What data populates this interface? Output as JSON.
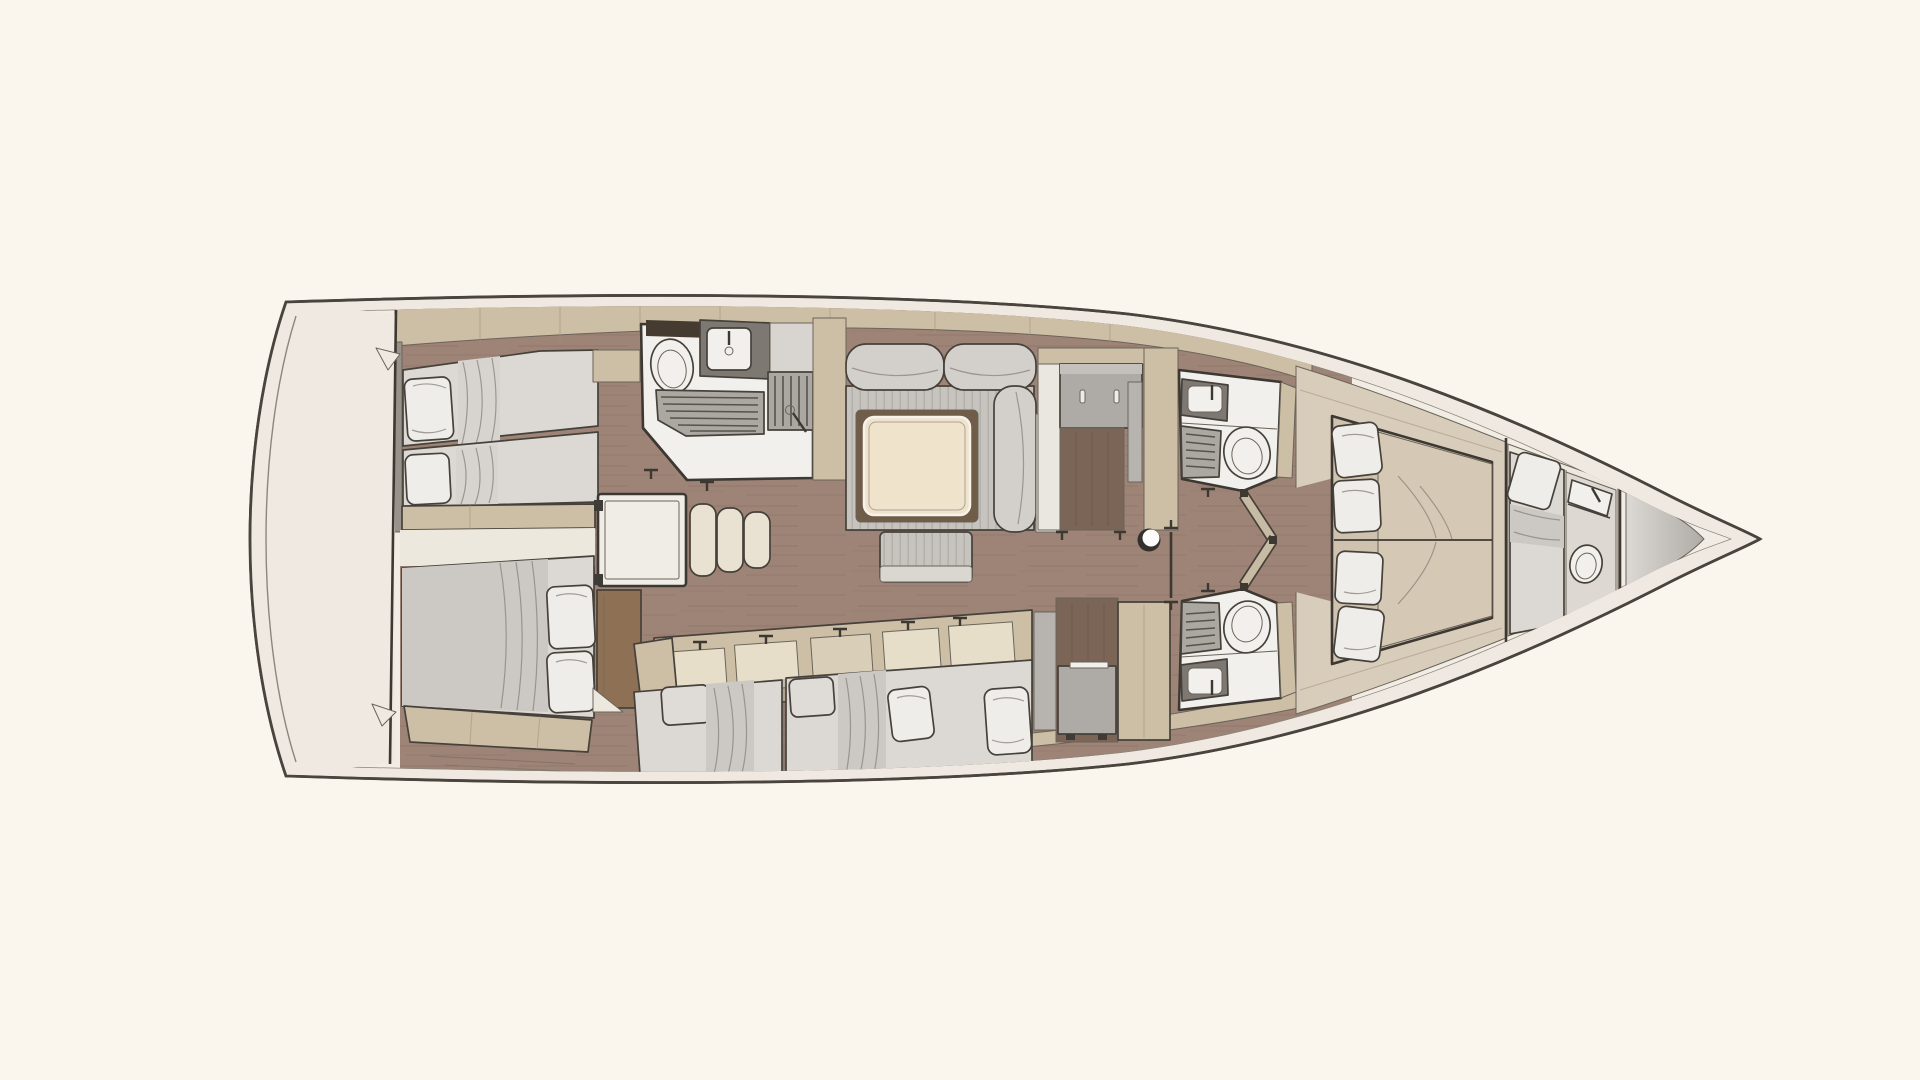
{
  "title": "Sailing yacht interior floor plan (top view, bow to the right)",
  "palette": {
    "background": "#FAF6ED",
    "hull_deck": "#F0E9E1",
    "hull_outline": "#49443D",
    "inner_line": "#8D867C",
    "interior_base": "#F2EDE4",
    "wood_floor": "#9D8476",
    "wood_streak": "#866C5E",
    "wall_tan": "#CDBFA6",
    "wall_gray": "#98928A",
    "platform_beige": "#D8CCBA",
    "floor_cream": "#EDE8DE",
    "mattress_light": "#DCD8D3",
    "mattress_tan": "#D5C8B4",
    "bed_base_tan": "#CFC3B0",
    "duvet_gray": "#CCC8C3",
    "duvet_band": "#D7D3CE",
    "pillow_white": "#EFEDEA",
    "pillow_gray": "#DFDBD6",
    "sofa_gray": "#C7C4BF",
    "sofa_stripe": "#B4B0AA",
    "sofa_back": "#D3CFCA",
    "table_top": "#EFE3CC",
    "table_shadow": "#6F5C49",
    "ottoman_band": "#DAD6D0",
    "counter_gray": "#7D7972",
    "fixture_white": "#F2F0EC",
    "slat_gray": "#ABA7A1",
    "recess_brown": "#7A6557",
    "cabinet_gray": "#AEAAA5",
    "door_gray": "#B7B3AE",
    "panel_cream": "#E7DEC9",
    "panel_light": "#EAE7E1",
    "wood_desk": "#8E7155",
    "dark_strip": "#453B31",
    "locker_light": "#DCD8D3",
    "locker_dark": "#AFABA6",
    "mast_ring": "#34302B",
    "mast_fill": "#FDFCFA"
  },
  "vessel": {
    "view": "top-down interior layout",
    "orientation": "bow-right-stern-left"
  },
  "regions": {
    "stern_deck": "stern deck / transom",
    "aft_cabin_port": "aft cabin with twin single berths",
    "aft_cabin_starboard": "aft cabin with double berth and desk",
    "aft_head": "aft head with toilet, sink and shower",
    "nav_station": "chart table with seat",
    "saloon": "saloon with L-sofa, square table and ottoman",
    "companionway": "companionway cabinet and stair recess",
    "mast_post": "mast compression post",
    "mid_head_port": "port midship head (sink, shower bench, toilet)",
    "mid_head_starboard": "starboard midship head (sink, shower bench, toilet)",
    "owner_cabin": "forward owner cabin with island double berth and four pillows",
    "bow_cabin": "bow cabin with single berth",
    "bow_head": "bow head with toilet and washbasin",
    "sail_locker": "forepeak sail locker"
  }
}
